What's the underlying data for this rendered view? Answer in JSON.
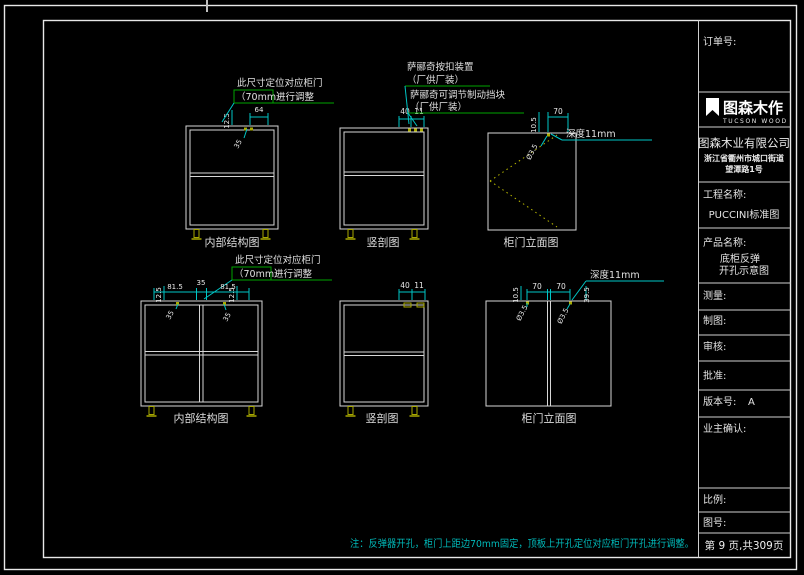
{
  "colors": {
    "background": "#000000",
    "frame": "#e8e8e8",
    "cabinet_line": "#d6d6d6",
    "dimension_cyan": "#00c6c6",
    "leader_green": "#00a400",
    "hardware_yellow": "#aaaa00",
    "note_cyan": "#00b9b9"
  },
  "titleblock": {
    "order_label": "订单号:",
    "logo": {
      "name": "图森木作",
      "sub": "TUCSON WOOD"
    },
    "company": "图森木业有限公司",
    "address1": "浙江省衢州市城口街道",
    "address2": "望潭路1号",
    "project_label": "工程名称:",
    "project_value": "PUCCINI标准图",
    "product_label": "产品名称:",
    "product_line1": "底柜反弹",
    "product_line2": "开孔示意图",
    "measure_label": "测量:",
    "draft_label": "制图:",
    "audit_label": "审核:",
    "approve_label": "批准:",
    "version_label": "版本号:",
    "version_value": "A",
    "owner_confirm_label": "业主确认:",
    "scale_label": "比例:",
    "drawing_no_label": "图号:",
    "page_info": "第 9 页,共309页"
  },
  "views": {
    "top_left_label": "内部结构图",
    "top_mid_label": "竖剖图",
    "top_right_label": "柜门立面图",
    "bottom_left_label": "内部结构图",
    "bottom_mid_label": "竖剖图",
    "bottom_right_label": "柜门立面图"
  },
  "annotations": {
    "fit_line1": "此尺寸定位对应柜门",
    "fit_70": "（70mm）",
    "fit_line2": "进行调整",
    "hw1_line1": "萨郦奇按扣装置",
    "hw1_line2": "（厂供厂装）",
    "hw2_line1": "萨郦奇可调节制动挡块",
    "hw2_line2": "（厂供厂装）",
    "depth_note": "深度11mm",
    "bottom_note": "注：反弹器开孔，柜门上距边70mm固定，顶板上开孔定位对应柜门开孔进行调整。"
  },
  "dims": {
    "tl": {
      "v": "12.5",
      "w": "64",
      "diag": "35"
    },
    "tm": {
      "a": "40",
      "b": "11"
    },
    "tr": {
      "v": "10.5",
      "w": "70",
      "hole": "Ø3.5"
    },
    "bl": {
      "e1": "81.5",
      "mid": "35",
      "e2": "81.5",
      "v1": "12.5",
      "v2": "12.5",
      "diag1": "35",
      "diag2": "35"
    },
    "bm": {
      "a": "40",
      "b": "11"
    },
    "br": {
      "w1": "70",
      "w2": "70",
      "v1": "10.5",
      "v2": "39.5",
      "hole1": "Ø3.5",
      "hole2": "Ø3.5"
    }
  }
}
